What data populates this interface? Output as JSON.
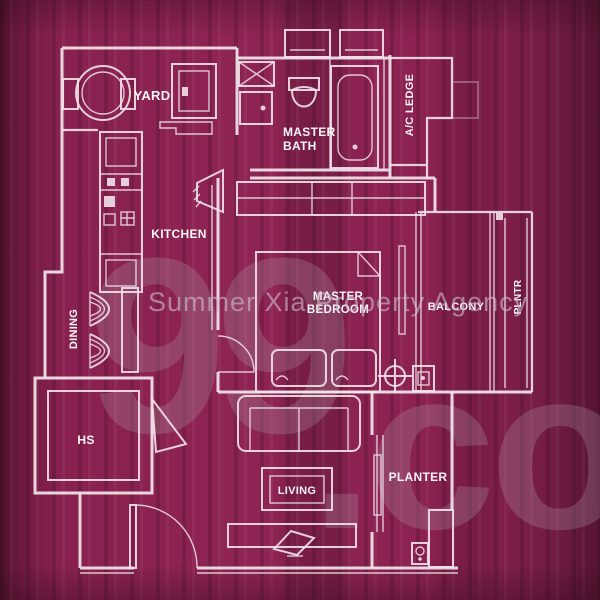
{
  "meta": {
    "type": "residential-floor-plan"
  },
  "colors": {
    "background": "#8a2150",
    "line": "#f1e3ea",
    "label_text": "#ffffff",
    "watermark_text": "#cdbcca",
    "brand_watermark": "#b197a8"
  },
  "rooms": {
    "yard": {
      "label": "YARD"
    },
    "kitchen": {
      "label": "KITCHEN"
    },
    "master_bath": {
      "label_line1": "MASTER",
      "label_line2": "BATH"
    },
    "ac_ledge": {
      "label": "A/C LEDGE"
    },
    "master_bedroom": {
      "label_line1": "MASTER",
      "label_line2": "BEDROOM"
    },
    "balcony": {
      "label": "BALCONY"
    },
    "side_strip": {
      "label": "PLNTR"
    },
    "dining": {
      "label": "DINING"
    },
    "household_shelter": {
      "label": "HS"
    },
    "living": {
      "label": "LIVING"
    },
    "planter": {
      "label": "PLANTER"
    }
  },
  "watermarks": {
    "agency": "Summer Xia Property Agency",
    "brand_first": "99",
    "brand_rest": ".co"
  }
}
